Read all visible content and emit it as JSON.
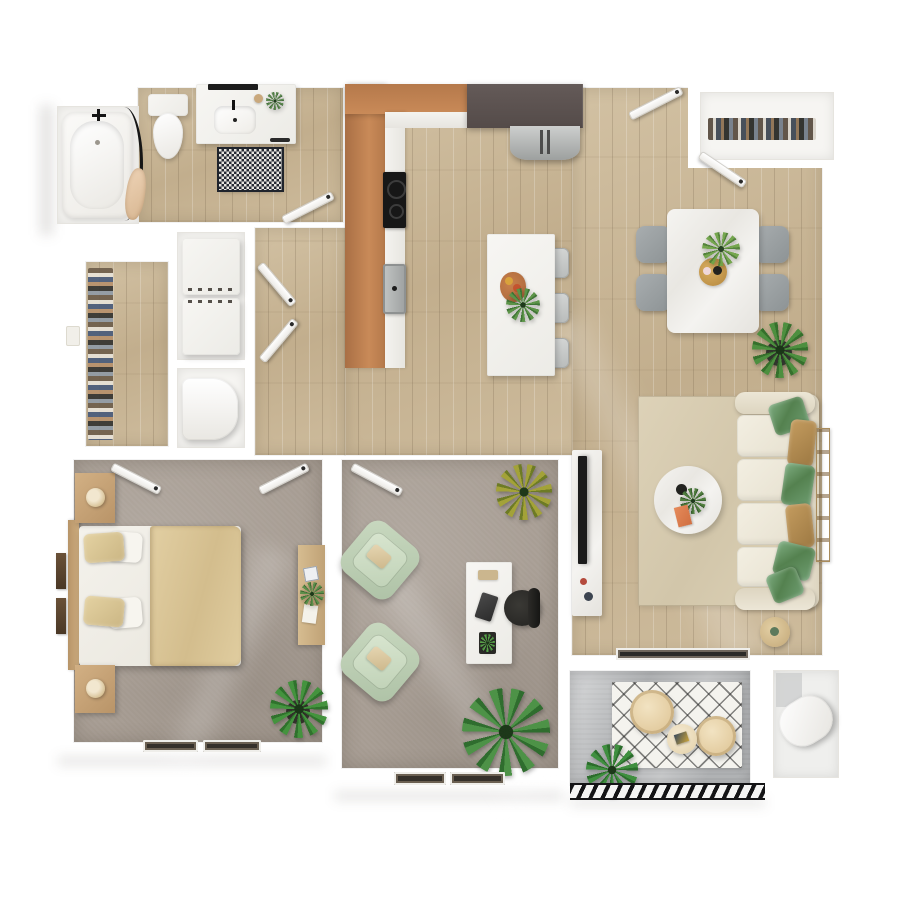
{
  "meta": {
    "description": "3D top-down rendered floor plan of a one-bedroom apartment with den and balcony",
    "view": "top-down 3D render",
    "text_on_image": "none"
  },
  "palette": {
    "background": "#ffffff",
    "wall_white": "#f6f5f2",
    "wood_floor": "#c7b494",
    "carpet": "#a69c92",
    "concrete": "#b4b6b8",
    "cabinet_wood": "#b97c4e",
    "cabinet_dark": "#5a5150",
    "stainless": "#b9bcbd",
    "marble_white": "#f2f1ed",
    "sofa_cream": "#ebe5d6",
    "pillow_green": "#5f8f63",
    "pillow_tan": "#b28a50",
    "duvet_tan": "#dcc89c",
    "armchair_sage": "#c6d6bd",
    "dining_chair_gray": "#9aa0a2",
    "plant_green": "#4e8a45",
    "accent_gold": "#c79a4b",
    "rug_living": "#d9ceb3",
    "rug_bath": "#262a33",
    "balcony_chair": "#ecd9b0"
  },
  "rooms": {
    "bathroom": {
      "name": "Bathroom",
      "floor": "wood",
      "furniture": [
        "bathtub",
        "shower-curtain",
        "toilet",
        "vanity-with-sink",
        "mirror",
        "checker-bath-rug"
      ]
    },
    "closet": {
      "name": "Walk-in Closet",
      "floor": "wood",
      "furniture": [
        "hanging-clothes-rail"
      ]
    },
    "laundry": {
      "name": "Laundry Nook",
      "floor": "none",
      "furniture": [
        "stacked-washer-dryer",
        "water-heater"
      ]
    },
    "hallway": {
      "name": "Hallway",
      "floor": "wood",
      "furniture": [
        "doors"
      ]
    },
    "kitchen": {
      "name": "Kitchen",
      "floor": "wood",
      "furniture": [
        "l-shaped-wood-cabinets",
        "dark-upper-cabinets",
        "cooktop",
        "kitchen-sink",
        "refrigerator",
        "island-with-stools",
        "fruit-board",
        "island-plant"
      ]
    },
    "dining": {
      "name": "Dining Area",
      "floor": "wood",
      "furniture": [
        "marble-dining-table",
        "four-gray-chairs",
        "gold-centerpiece",
        "potted-plant"
      ]
    },
    "entry": {
      "name": "Entry",
      "floor": "wood",
      "furniture": [
        "entry-door",
        "coat-closet-with-clothes"
      ]
    },
    "living": {
      "name": "Living Room",
      "floor": "wood",
      "furniture": [
        "cream-sofa-with-pillows",
        "round-marble-coffee-table",
        "tv-console",
        "tv",
        "beige-area-rug",
        "round-side-table",
        "ladder-shelf",
        "sliding-glass-door"
      ]
    },
    "bedroom": {
      "name": "Bedroom",
      "floor": "carpet",
      "furniture": [
        "bed-with-tan-duvet",
        "two-nightstands",
        "two-lamps",
        "wall-art",
        "desk-dresser",
        "potted-plant",
        "windows"
      ]
    },
    "office": {
      "name": "Den / Office",
      "floor": "carpet",
      "furniture": [
        "two-sage-armchairs",
        "white-desk",
        "black-office-chair",
        "desk-plant",
        "spiky-plant",
        "large-plant",
        "window"
      ]
    },
    "balcony": {
      "name": "Balcony",
      "floor": "concrete",
      "furniture": [
        "two-round-lounge-chairs",
        "round-table",
        "lattice-outdoor-rug",
        "spiky-plant",
        "hatched-railing"
      ]
    },
    "storage": {
      "name": "Storage Closet",
      "floor": "none",
      "furniture": [
        "water-tank-cylinder"
      ]
    }
  },
  "counts": {
    "dining_chairs": 4,
    "bar_stools": 3,
    "sofa_seat_cushions": 4,
    "armchairs": 2,
    "balcony_chairs": 2,
    "washer_dryer_units": 2,
    "bedroom_windows": 2,
    "office_windows": 2
  }
}
